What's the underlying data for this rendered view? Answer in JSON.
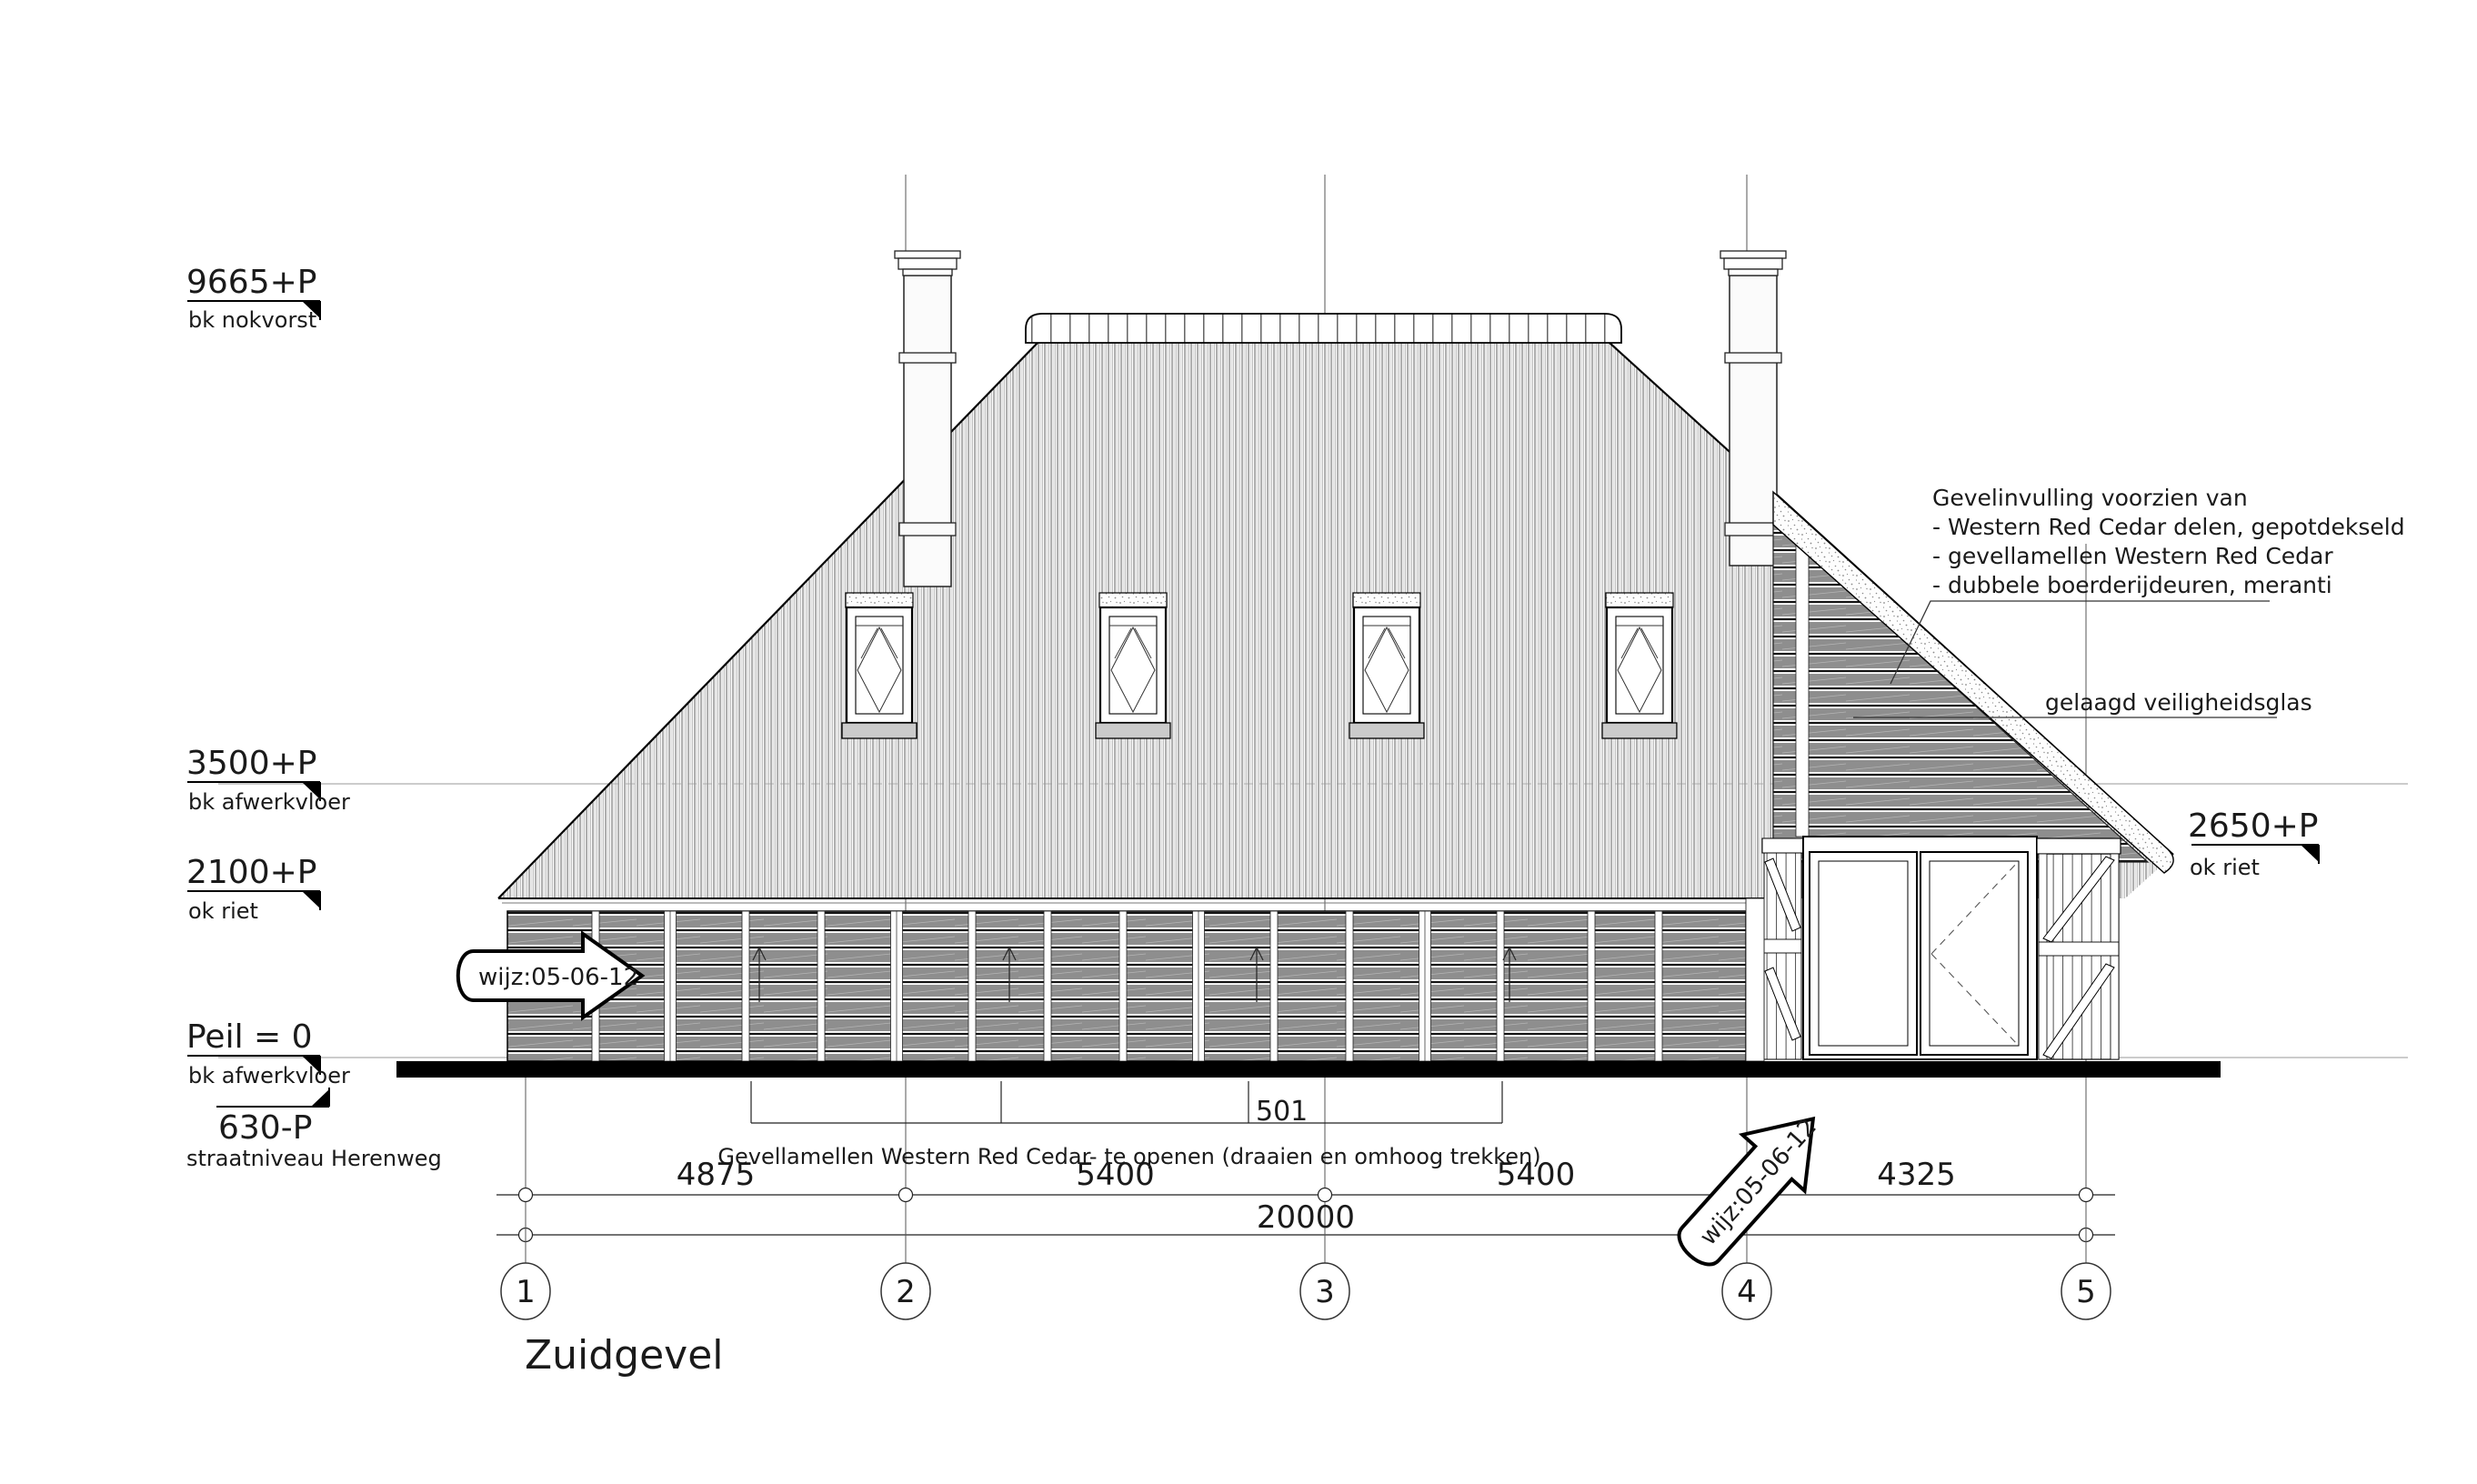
{
  "drawing": {
    "title": "Zuidgevel"
  },
  "levels": {
    "left": [
      {
        "value": "9665+P",
        "label": "bk nokvorst"
      },
      {
        "value": "3500+P",
        "label": "bk afwerkvloer"
      },
      {
        "value": "2100+P",
        "label": "ok riet"
      },
      {
        "value": "Peil = 0",
        "label": "bk afwerkvloer"
      },
      {
        "value": "630-P",
        "label": "straatniveau Herenweg"
      }
    ],
    "right": {
      "value": "2650+P",
      "label": "ok riet"
    }
  },
  "annotations": {
    "facade_note": {
      "line1": "Gevelinvulling voorzien van",
      "line2": "- Western Red Cedar delen, gepotdekseld",
      "line3": "- gevellamellen Western Red Cedar",
      "line4": "- dubbele boerderijdeuren, meranti"
    },
    "glass_note": "gelaagd veiligheidsglas",
    "louvre_caption": "Gevellamellen Western Red Cedar- te openen  (draaien en omhoog trekken)",
    "bracket_label": "501",
    "revision_stamp": "wijz:05-06-12"
  },
  "dimensions": {
    "segments": [
      "4875",
      "5400",
      "5400",
      "4325"
    ],
    "total": "20000"
  },
  "grid": {
    "labels": [
      "1",
      "2",
      "3",
      "4",
      "5"
    ]
  }
}
